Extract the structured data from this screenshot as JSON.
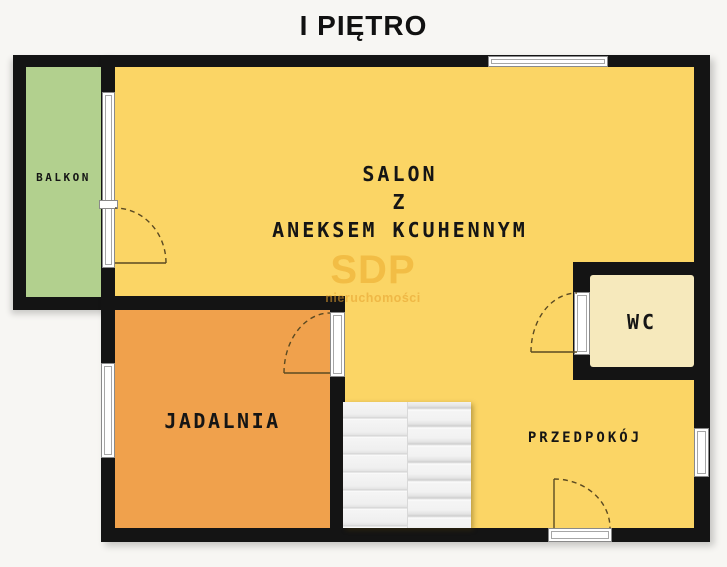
{
  "title": "I PIĘTRO",
  "watermark": {
    "brand": "SDP",
    "subtitle": "nieruchomości"
  },
  "rooms": {
    "balkon": {
      "label": "BALKON",
      "color": "#b2d08e"
    },
    "salon": {
      "label_line1": "SALON",
      "label_line2": "Z",
      "label_line3": "ANEKSEM KCUHENNYM",
      "color": "#fbd565"
    },
    "jadalnia": {
      "label": "JADALNIA",
      "color": "#f0a14c"
    },
    "wc": {
      "label": "WC",
      "color": "#f6e9bc"
    },
    "przedpokoj": {
      "label": "PRZEDPOKÓJ",
      "color": "#fbd565"
    }
  },
  "features": {
    "stairs": "staircase",
    "doors": [
      "balcony-door",
      "jadalnia-door",
      "wc-door",
      "entrance-door"
    ],
    "windows": [
      "top-window",
      "left-window",
      "right-window",
      "balcony-glazing"
    ]
  },
  "colors": {
    "wall": "#141414",
    "background": "#f7f6f3",
    "stairs": "#f2f2f2",
    "door_arc": "#5b4a22",
    "title_text": "#111111"
  }
}
